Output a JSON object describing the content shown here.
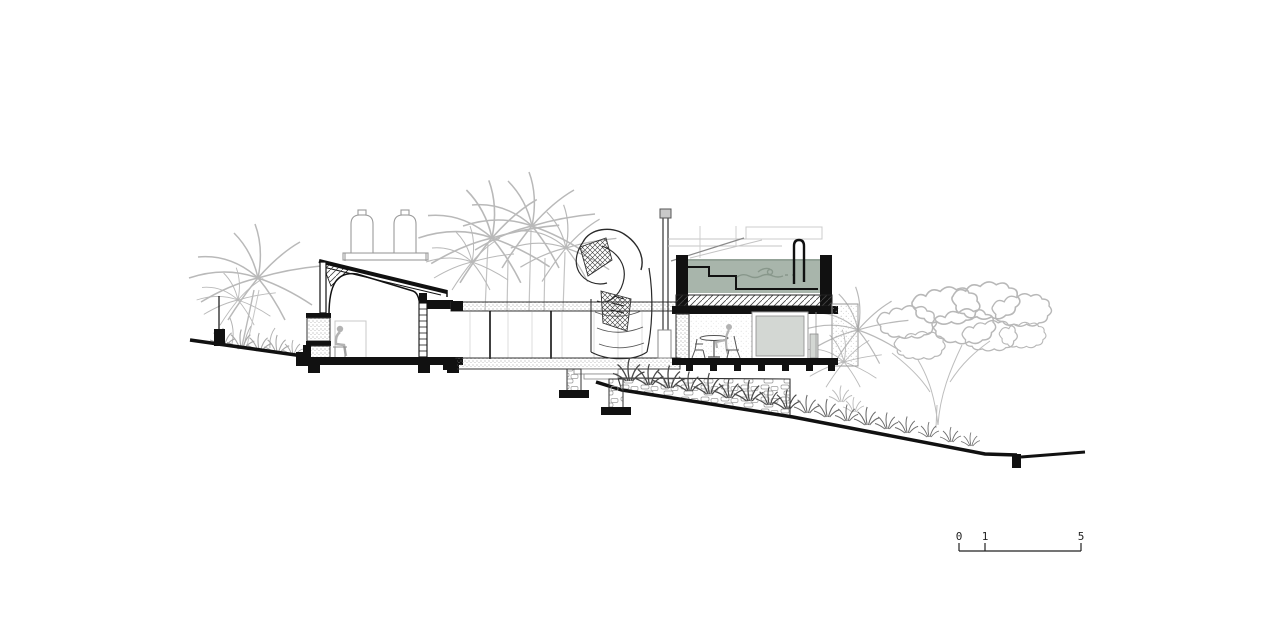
{
  "document": {
    "type": "architectural-section-drawing",
    "background": "#ffffff"
  },
  "colors": {
    "linework": "#1a1a1a",
    "vegetation": "#b9b9b9",
    "pool_water": "#a8b5ab",
    "water_edge": "#7e8f83",
    "panel_gray": "#d3d7d3",
    "figure_gray": "#b3b3b3",
    "chimney_cap_gray": "#c9c9c9"
  },
  "scale_bar": {
    "labels": [
      "0",
      "1",
      "5"
    ]
  }
}
